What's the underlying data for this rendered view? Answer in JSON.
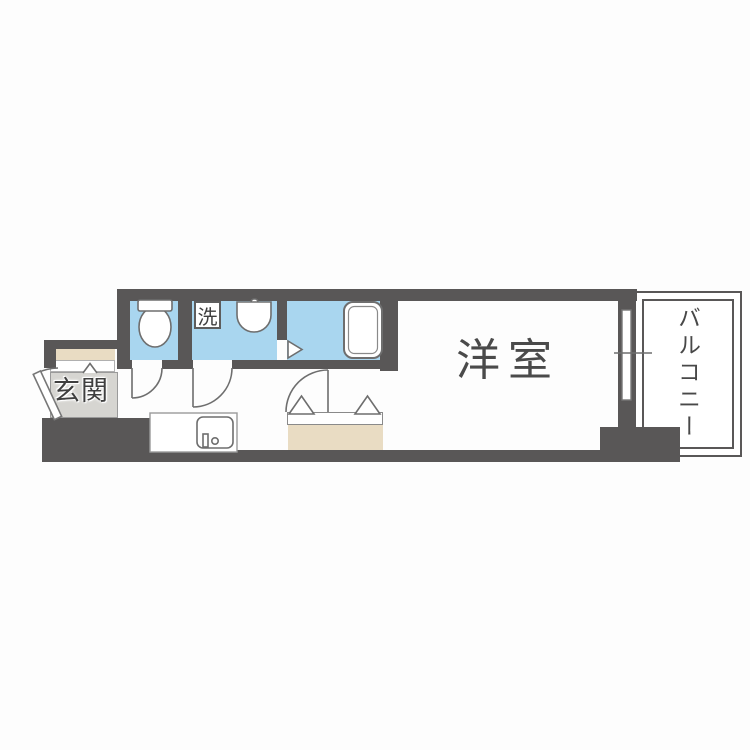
{
  "plan": {
    "labels": {
      "western_room": "洋室",
      "entrance": "玄関",
      "balcony": "バルコニー",
      "washer": "洗"
    },
    "colors": {
      "wall": "#595757",
      "water_blue": "#a9d6ef",
      "beige": "#e9dcc3",
      "entrance_gray": "#d6d5d1",
      "fixture_line": "#6e6e6e",
      "label_text": "#3f3f3f"
    }
  }
}
